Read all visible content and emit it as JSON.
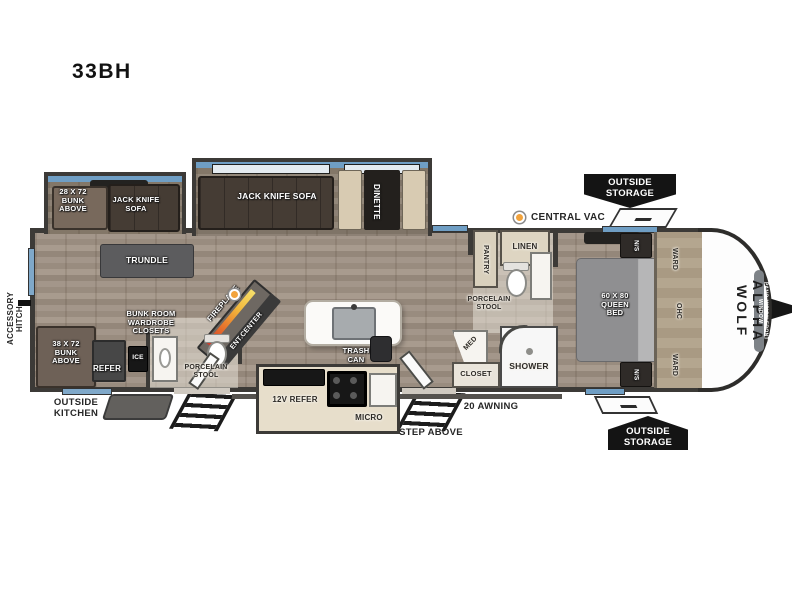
{
  "title": "33BH",
  "brand": {
    "name": "ALPHA WOLF",
    "front_window": "PANO-VISION FRONT WINDOW"
  },
  "exterior": {
    "accessory_hitch": "ACCESSORY HITCH",
    "outside_kitchen": "OUTSIDE KITCHEN",
    "awning": "20 AWNING",
    "step_above": "STEP ABOVE",
    "storage_front_top": "OUTSIDE STORAGE",
    "storage_front_bottom": "OUTSIDE STORAGE",
    "central_vac": "CENTRAL VAC"
  },
  "bunk_slide": {
    "bunk_above": "28 X 72 BUNK ABOVE",
    "sofa": "JACK KNIFE SOFA"
  },
  "living": {
    "sofa": "JACK KNIFE SOFA",
    "dinette": "DINETTE",
    "trundle": "TRUNDLE",
    "ent_center": "ENT.CENTER",
    "fireplace": "FIREPLACE",
    "trash_can": "TRASH CAN"
  },
  "bunk_room": {
    "bunk": "38 X 72 BUNK ABOVE",
    "wardrobe": "BUNK ROOM WARDROBE CLOSETS",
    "refer": "REFER",
    "ice": "ICE",
    "toilet": "PORCELAIN STOOL"
  },
  "kitchen": {
    "refer": "12V REFER",
    "micro": "MICRO"
  },
  "bathroom": {
    "pantry": "PANTRY",
    "linen": "LINEN",
    "toilet": "PORCELAIN STOOL",
    "med": "MED",
    "closet": "CLOSET",
    "shower": "SHOWER"
  },
  "bedroom": {
    "bed": "60 X 80 QUEEN BED",
    "nightstand_top": "N/S",
    "nightstand_bottom": "N/S",
    "wardrobe_top": "WARD",
    "wardrobe_bottom": "WARD",
    "cabinet": "OHC"
  },
  "colors": {
    "accent_blue": "#6f9ec4",
    "marker_orange": "#f2a33c",
    "badge_black": "#141414"
  }
}
